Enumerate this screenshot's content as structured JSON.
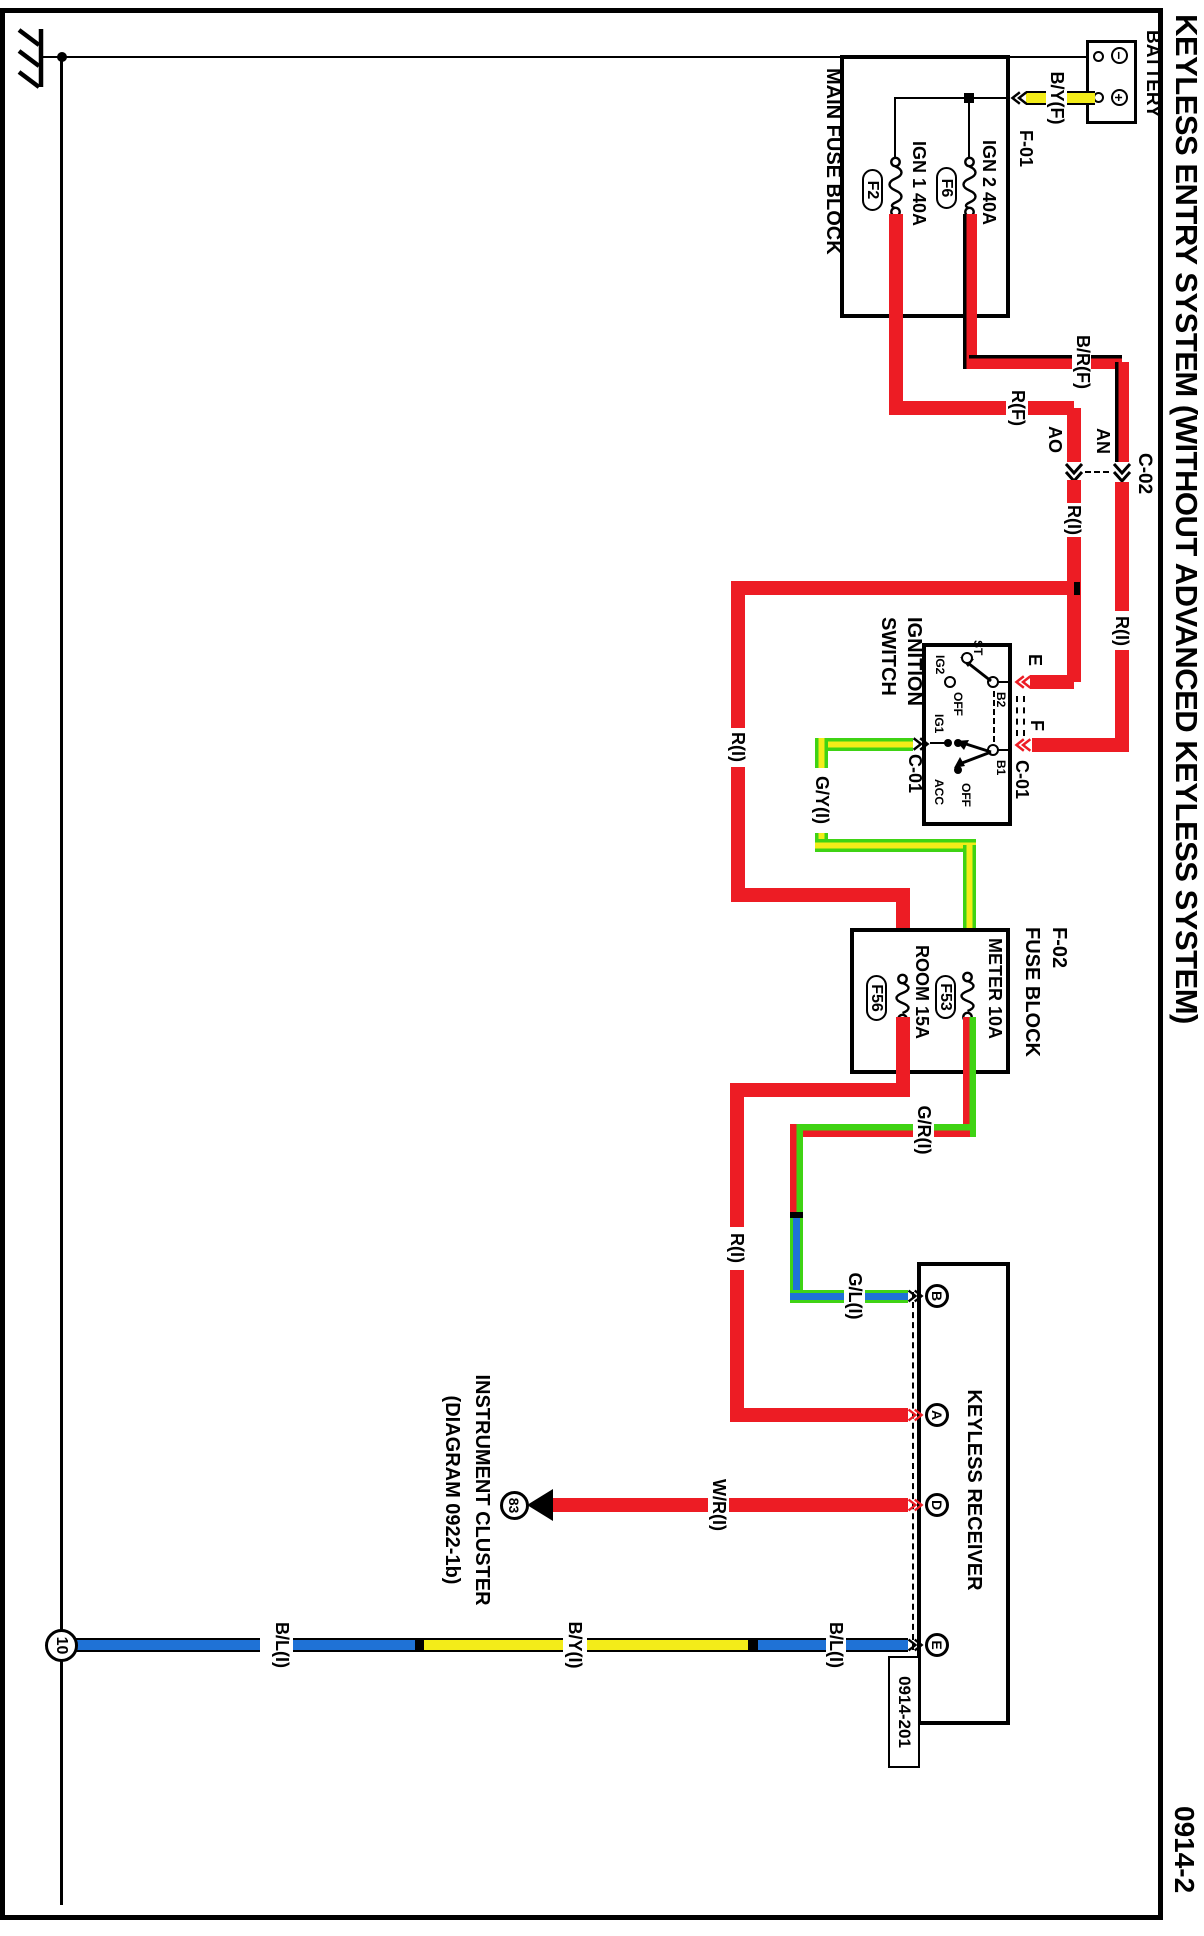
{
  "title": "KEYLESS ENTRY SYSTEM (WITHOUT ADVANCED KEYLESS SYSTEM)",
  "page_ref": "0914-2",
  "colors": {
    "wire_red": "#ed1c24",
    "wire_yellow": "#f3ec19",
    "wire_green": "#3fd314",
    "wire_blue": "#1f72d6",
    "line_black": "#000000"
  },
  "battery": {
    "label": "BATTERY",
    "neg_symbol": "−",
    "pos_symbol": "+"
  },
  "main_fuse_block": {
    "label": "MAIN FUSE BLOCK",
    "connector_label": "F-01",
    "fuses": [
      {
        "id": "F6",
        "name": "IGN 2 40A"
      },
      {
        "id": "F2",
        "name": "IGN 1 40A"
      }
    ]
  },
  "c02": {
    "label": "C-02",
    "cavity_top": "AN",
    "cavity_bottom": "AO"
  },
  "ignition_switch": {
    "label1": "IGNITION",
    "label2": "SWITCH",
    "connector": "C-01",
    "t_e": "E",
    "t_f": "F",
    "t_b1": "B1",
    "t_b2": "B2",
    "t_st": "ST",
    "t_ig1": "IG1",
    "t_ig2": "IG2",
    "t_acc": "ACC",
    "t_off": "OFF"
  },
  "f02_block": {
    "label1": "F-02",
    "label2": "FUSE BLOCK",
    "fuses": [
      {
        "id": "F53",
        "name": "METER 10A"
      },
      {
        "id": "F56",
        "name": "ROOM 15A"
      }
    ]
  },
  "receiver": {
    "label": "KEYLESS RECEIVER",
    "connector_ref": "0914-201",
    "t_b": "B",
    "t_a": "A",
    "t_d": "D",
    "t_e": "E"
  },
  "instrument_cluster": {
    "ref_num": "83",
    "line1": "INSTRUMENT CLUSTER",
    "line2": "(DIAGRAM 0922-1b)"
  },
  "ground_point": {
    "id": "10"
  },
  "wire_labels": {
    "by_f": "B/Y(F)",
    "br_f": "B/R(F)",
    "r_f": "R(F)",
    "r_i": "R(I)",
    "gy_i": "G/Y(I)",
    "gr_i": "G/R(I)",
    "gl_i": "G/L(I)",
    "wr_i": "W/R(I)",
    "bl_i": "B/L(I)",
    "by_i": "B/Y(I)"
  }
}
